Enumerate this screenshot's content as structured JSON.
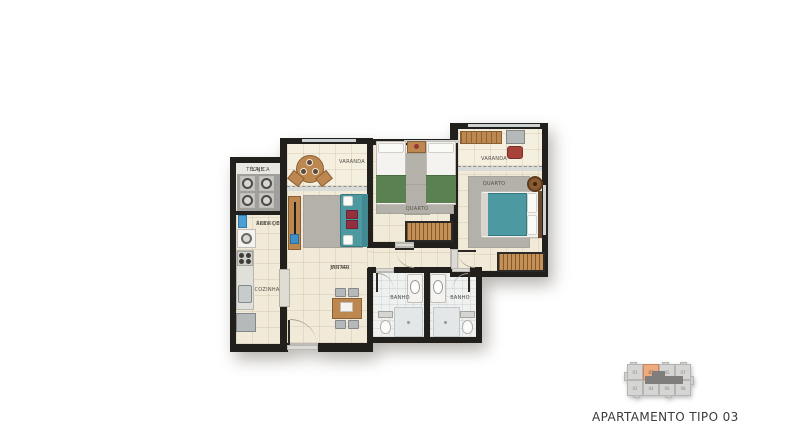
{
  "title": "APARTAMENTO TIPO 03",
  "plan": {
    "rooms": {
      "laje_tecnica": {
        "line1": "LAJE",
        "line2": "TÉCNICA"
      },
      "area_servico": {
        "line1": "ÁREA DE",
        "line2": "SERVIÇO"
      },
      "cozinha": {
        "label": "COZINHA"
      },
      "estar_jantar": {
        "line1": "ESTAR/",
        "line2": "JANTAR"
      },
      "varanda_esquerda": {
        "label": "VARANDA"
      },
      "quarto_1": {
        "label": "QUARTO"
      },
      "varanda_direita": {
        "label": "VARANDA"
      },
      "quarto_2": {
        "label": "QUARTO"
      },
      "banho_1": {
        "label": "BANHO"
      },
      "banho_2": {
        "label": "BANHO"
      }
    },
    "colors": {
      "wall": "#22201d",
      "floor": "#f1ead8",
      "varanda_floor": "#f5efdf",
      "bath_floor": "#eef1f0",
      "wood": "#bd8750",
      "sofa_teal": "#4d99a1",
      "blanket_green": "#5b8052",
      "rug_gray": "#b4b1aa",
      "cushion_red": "#93303f"
    }
  },
  "keyplan": {
    "highlighted_unit": "03",
    "highlight_color": "#ecac80",
    "units_top": [
      "01",
      "03",
      "05",
      "07"
    ],
    "units_bottom": [
      "02",
      "04",
      "06",
      "08"
    ]
  }
}
